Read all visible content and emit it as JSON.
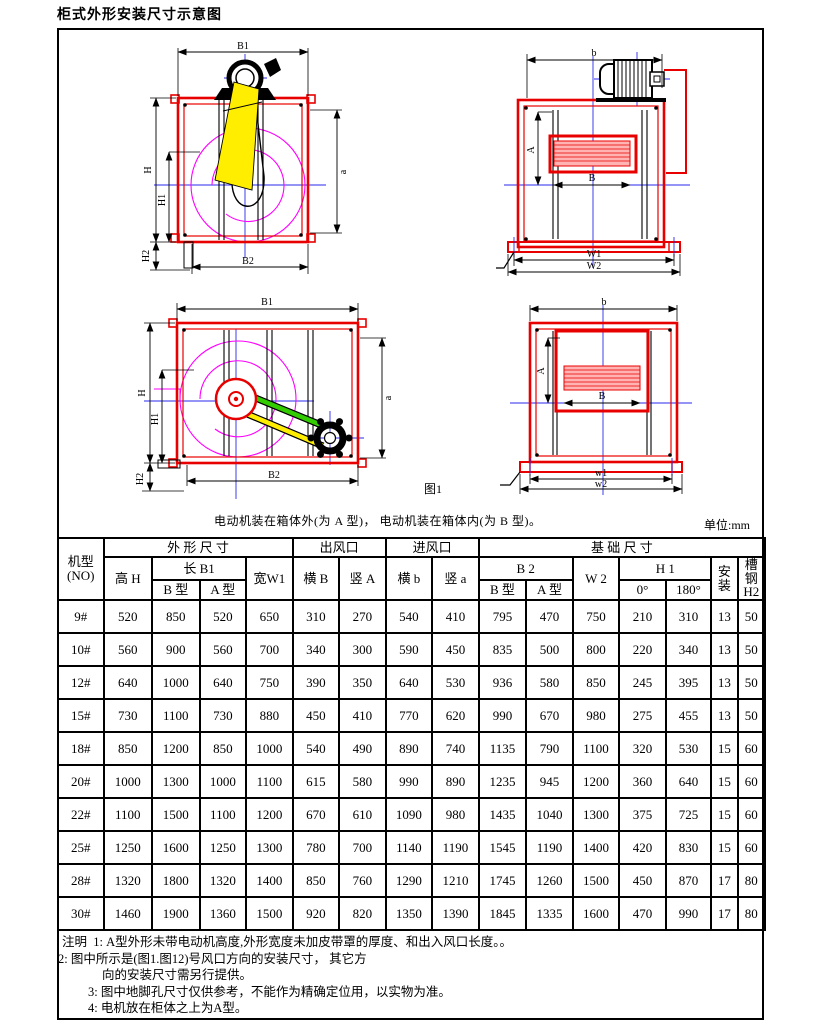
{
  "title": "柜式外形安装尺寸示意图",
  "figure": {
    "caption": "电动机装在箱体外(为 A 型)， 电动机装在箱体内(为 B 型)。",
    "figure_label": "图1",
    "unit_label": "单位:mm",
    "colors": {
      "frame_red": "#e80000",
      "centerline_blue": "#2a2aee",
      "volute_magenta": "#ff00ff",
      "belt_yellow": "#ffee00",
      "belt_green": "#33cc00"
    },
    "labels": {
      "front_a": {
        "b1": "B1",
        "h": "H",
        "h1": "H1",
        "h2": "H2",
        "b2": "B2",
        "a": "a"
      },
      "side_a": {
        "b": "b",
        "a_dim": "A",
        "b_dim": "B",
        "w1": "W1",
        "w2": "W2"
      },
      "front_b": {
        "b1": "B1",
        "h": "H",
        "h1": "H1",
        "h2": "H2",
        "b2": "B2",
        "a": "a"
      },
      "side_b": {
        "b": "b",
        "a_dim": "A",
        "b_dim": "B",
        "w1": "w1",
        "w2": "w2"
      }
    }
  },
  "table": {
    "header": {
      "model": "机型",
      "model_sub": "(NO)",
      "outline_dims": "外 形 尺 寸",
      "height_h": "高 H",
      "length_b1": "长 B1",
      "type_b": "B 型",
      "type_a": "A 型",
      "width_w1": "宽W1",
      "outlet": "出风口",
      "outlet_h": "横 B",
      "outlet_v": "竖 A",
      "inlet": "进风口",
      "inlet_h": "横 b",
      "inlet_v": "竖 a",
      "base_dims": "基 础 尺 寸",
      "b2": "B 2",
      "b2_type_b": "B 型",
      "b2_type_a": "A 型",
      "w2": "W 2",
      "h1": "H 1",
      "deg0": "0°",
      "deg180": "180°",
      "install": "安装",
      "channel": "槽钢",
      "channel_sub": "H2"
    },
    "rows": [
      {
        "model": "9#",
        "values": [
          "520",
          "850",
          "520",
          "650",
          "310",
          "270",
          "540",
          "410",
          "795",
          "470",
          "750",
          "210",
          "310",
          "13",
          "50"
        ]
      },
      {
        "model": "10#",
        "values": [
          "560",
          "900",
          "560",
          "700",
          "340",
          "300",
          "590",
          "450",
          "835",
          "500",
          "800",
          "220",
          "340",
          "13",
          "50"
        ]
      },
      {
        "model": "12#",
        "values": [
          "640",
          "1000",
          "640",
          "750",
          "390",
          "350",
          "640",
          "530",
          "936",
          "580",
          "850",
          "245",
          "395",
          "13",
          "50"
        ]
      },
      {
        "model": "15#",
        "values": [
          "730",
          "1100",
          "730",
          "880",
          "450",
          "410",
          "770",
          "620",
          "990",
          "670",
          "980",
          "275",
          "455",
          "13",
          "50"
        ]
      },
      {
        "model": "18#",
        "values": [
          "850",
          "1200",
          "850",
          "1000",
          "540",
          "490",
          "890",
          "740",
          "1135",
          "790",
          "1100",
          "320",
          "530",
          "15",
          "60"
        ]
      },
      {
        "model": "20#",
        "values": [
          "1000",
          "1300",
          "1000",
          "1100",
          "615",
          "580",
          "990",
          "890",
          "1235",
          "945",
          "1200",
          "360",
          "640",
          "15",
          "60"
        ]
      },
      {
        "model": "22#",
        "values": [
          "1100",
          "1500",
          "1100",
          "1200",
          "670",
          "610",
          "1090",
          "980",
          "1435",
          "1040",
          "1300",
          "375",
          "725",
          "15",
          "60"
        ]
      },
      {
        "model": "25#",
        "values": [
          "1250",
          "1600",
          "1250",
          "1300",
          "780",
          "700",
          "1140",
          "1190",
          "1545",
          "1190",
          "1400",
          "420",
          "830",
          "15",
          "60"
        ]
      },
      {
        "model": "28#",
        "values": [
          "1320",
          "1800",
          "1320",
          "1400",
          "850",
          "760",
          "1290",
          "1210",
          "1745",
          "1260",
          "1500",
          "450",
          "870",
          "17",
          "80"
        ]
      },
      {
        "model": "30#",
        "values": [
          "1460",
          "1900",
          "1360",
          "1500",
          "920",
          "820",
          "1350",
          "1390",
          "1845",
          "1335",
          "1600",
          "470",
          "990",
          "17",
          "80"
        ]
      }
    ]
  },
  "notes": {
    "line1": "注明  1: A型外形未带电动机高度,外形宽度未加皮带罩的厚度、和出入风口长度。。",
    "line2": "2: 图中所示是(图1.图12)号风口方向的安装尺寸， 其它方",
    "line3": "向的安装尺寸需另行提供。",
    "line4": "3: 图中地脚孔尺寸仅供参考，不能作为精确定位用，以实物为准。",
    "line5": "4: 电机放在柜体之上为A型。"
  }
}
